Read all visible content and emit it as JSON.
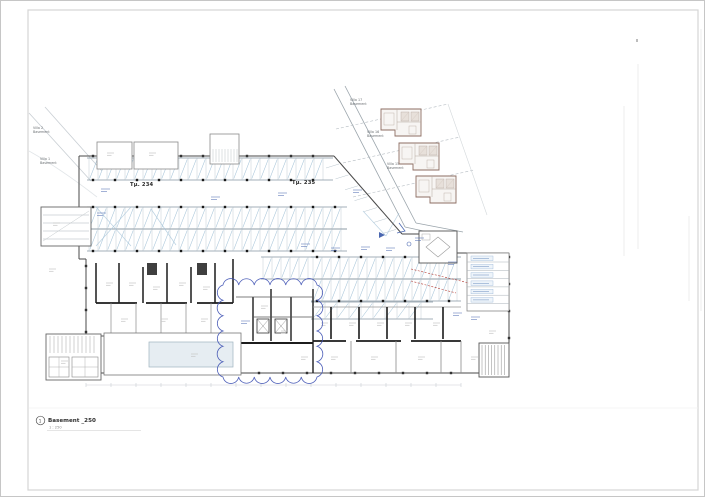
{
  "sheet": {
    "kind": "architectural-floor-plan"
  },
  "labels": {
    "tm234": "Τμ. 234",
    "tm235": "Τμ. 235"
  },
  "site": {
    "villa2": {
      "name": "Villa 2",
      "sub": "Basement"
    },
    "villa1": {
      "name": "Villa 1",
      "sub": "Basement"
    },
    "villa17": {
      "name": "Villa 17",
      "sub": "Basement"
    },
    "villa16": {
      "name": "Villa 16",
      "sub": "Basement"
    },
    "villa15": {
      "name": "Villa 15",
      "sub": "Basement"
    }
  },
  "titleblock": {
    "view_number": "1",
    "view_title": "Basement _250",
    "view_scale": "1 : 250"
  },
  "colors": {
    "sheet_border": "#d5d5d5",
    "faint_line": "#ededed",
    "wall_dark": "#1c1c1c",
    "wall_mid": "#4a4a4a",
    "thin_line": "#9aa4ab",
    "stall_line": "#b9c6cf",
    "hatch_blue": "#a9c6da",
    "annotation_blue": "#4a67b0",
    "cloud_blue": "#4053b4",
    "villa_wall": "#8d6e63",
    "villa_inner": "#b5a79d",
    "red_dashed": "#b23b33",
    "dot_black": "#1a1a1a",
    "label_gray": "#c6c6c6",
    "pool_fill": "#e6edf2",
    "shaft_fill": "#3f3f3f"
  }
}
